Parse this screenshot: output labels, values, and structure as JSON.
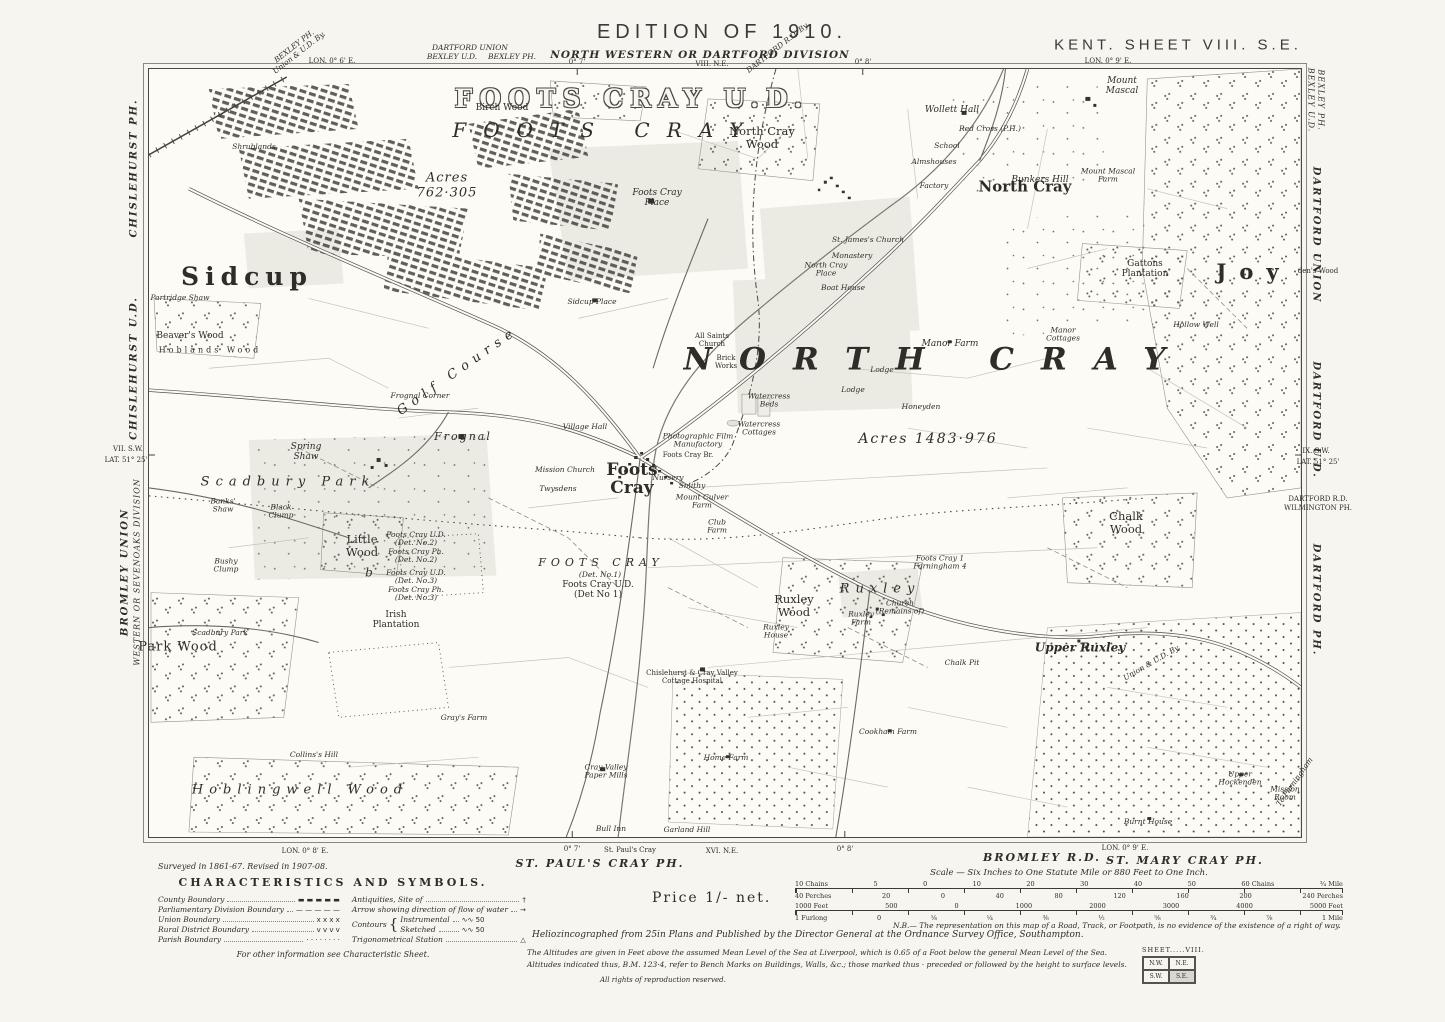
{
  "labels": [
    {
      "t": "EDITION OF 1910.",
      "x": 722,
      "y": 32,
      "c": "hdr",
      "n": "edition-title"
    },
    {
      "t": "KENT. SHEET VIII. S.E.",
      "x": 1178,
      "y": 46,
      "c": "hdr2",
      "n": "sheet-title"
    },
    {
      "t": "NORTH WESTERN OR DARTFORD DIVISION",
      "x": 700,
      "y": 56,
      "c": "div-it",
      "n": "division-title"
    },
    {
      "t": "VIII. N.E.",
      "x": 712,
      "y": 65,
      "c": "tiny",
      "n": "adjoining-sheet-north"
    },
    {
      "t": "DARTFORD UNION",
      "x": 470,
      "y": 48,
      "c": "tiny-it"
    },
    {
      "t": "BEXLEY U.D.",
      "x": 452,
      "y": 57,
      "c": "tiny-it"
    },
    {
      "t": "BEXLEY PH.",
      "x": 512,
      "y": 57,
      "c": "tiny-it"
    },
    {
      "t": "BEXLEY PH.\nUnion & U.D. By.",
      "x": 297,
      "y": 50,
      "c": "tiny-it",
      "r": -38
    },
    {
      "t": "LON. 0° 6' E.",
      "x": 332,
      "y": 62,
      "c": "tiny"
    },
    {
      "t": "0° 7'",
      "x": 577,
      "y": 63,
      "c": "tiny"
    },
    {
      "t": "DARTFORD R.D. By.",
      "x": 778,
      "y": 48,
      "c": "tiny-it",
      "r": -38
    },
    {
      "t": "0° 8'",
      "x": 863,
      "y": 63,
      "c": "tiny"
    },
    {
      "t": "LON. 0° 9' E.",
      "x": 1108,
      "y": 62,
      "c": "tiny"
    },
    {
      "t": "CHISLEHURST PH.",
      "x": 134,
      "y": 168,
      "c": "marg",
      "r": -90
    },
    {
      "t": "CHISLEHURST U.D.",
      "x": 134,
      "y": 368,
      "c": "marg",
      "r": -90
    },
    {
      "t": "VII. S.W.",
      "x": 128,
      "y": 450,
      "c": "tiny"
    },
    {
      "t": "LAT. 51° 25'",
      "x": 126,
      "y": 461,
      "c": "tiny"
    },
    {
      "t": "BROMLEY UNION",
      "x": 125,
      "y": 572,
      "c": "marg",
      "r": -90
    },
    {
      "t": "WESTERN OR SEVENOAKS DIVISION",
      "x": 138,
      "y": 572,
      "c": "marg-sm",
      "r": -90
    },
    {
      "t": "BEXLEY U.D.",
      "x": 1310,
      "y": 100,
      "c": "marg-sm",
      "r": 90
    },
    {
      "t": "BEXLEY PH.",
      "x": 1320,
      "y": 100,
      "c": "marg-sm",
      "r": 90
    },
    {
      "t": "DARTFORD UNION",
      "x": 1316,
      "y": 235,
      "c": "marg",
      "r": 90
    },
    {
      "t": "den's Wood",
      "x": 1318,
      "y": 272,
      "c": "tiny"
    },
    {
      "t": "DARTFORD U.D.",
      "x": 1316,
      "y": 420,
      "c": "marg",
      "r": 90
    },
    {
      "t": "IX. S.W.",
      "x": 1316,
      "y": 452,
      "c": "tiny"
    },
    {
      "t": "LAT. 51° 25'",
      "x": 1318,
      "y": 463,
      "c": "tiny"
    },
    {
      "t": "DARTFORD R.D.",
      "x": 1318,
      "y": 500,
      "c": "tiny"
    },
    {
      "t": "WILMINGTON PH.",
      "x": 1318,
      "y": 509,
      "c": "tiny"
    },
    {
      "t": "DARTFORD PH.",
      "x": 1316,
      "y": 600,
      "c": "marg",
      "r": 90
    },
    {
      "t": "LON. 0° 8' E.",
      "x": 305,
      "y": 852,
      "c": "tiny"
    },
    {
      "t": "0° 7'",
      "x": 572,
      "y": 850,
      "c": "tiny"
    },
    {
      "t": "St. Paul's Cray",
      "x": 630,
      "y": 851,
      "c": "tiny"
    },
    {
      "t": "ST. PAUL'S CRAY PH.",
      "x": 600,
      "y": 864,
      "c": "ph"
    },
    {
      "t": "XVI. N.E.",
      "x": 722,
      "y": 852,
      "c": "tiny",
      "n": "adjoining-sheet-south"
    },
    {
      "t": "0° 8'",
      "x": 845,
      "y": 850,
      "c": "tiny"
    },
    {
      "t": "BROMLEY R.D.",
      "x": 1042,
      "y": 858,
      "c": "ph"
    },
    {
      "t": "LON. 0° 9' E.",
      "x": 1125,
      "y": 849,
      "c": "tiny"
    },
    {
      "t": "ST. MARY CRAY PH.",
      "x": 1185,
      "y": 861,
      "c": "ph"
    },
    {
      "t": "FOOTS CRAY U.D.",
      "x": 632,
      "y": 99,
      "c": "outline",
      "n": "district-title"
    },
    {
      "t": "FOOTS CRAY",
      "x": 606,
      "y": 130,
      "c": "spread-it",
      "n": "parish-title"
    },
    {
      "t": "Acres\n762·305",
      "x": 447,
      "y": 186,
      "c": "acres"
    },
    {
      "t": "Birch Wood",
      "x": 502,
      "y": 108,
      "c": "sm"
    },
    {
      "t": "North Cray\nWood",
      "x": 762,
      "y": 138,
      "c": "wood"
    },
    {
      "t": "Sidcup",
      "x": 247,
      "y": 277,
      "c": "town",
      "n": "town-sidcup"
    },
    {
      "t": "NORTH CRAY",
      "x": 938,
      "y": 360,
      "c": "huge",
      "n": "parish-north-cray"
    },
    {
      "t": "Acres 1483·976",
      "x": 928,
      "y": 440,
      "c": "acres2"
    },
    {
      "t": "North Cray",
      "x": 1025,
      "y": 187,
      "c": "vill",
      "n": "village-north-cray"
    },
    {
      "t": "Mount\nMascal",
      "x": 1122,
      "y": 86,
      "c": "sm-it"
    },
    {
      "t": "Wollett Hall",
      "x": 952,
      "y": 110,
      "c": "sm-it"
    },
    {
      "t": "Red Cross (P.H.)",
      "x": 990,
      "y": 129,
      "c": "tiny-it"
    },
    {
      "t": "School",
      "x": 947,
      "y": 146,
      "c": "tiny-it"
    },
    {
      "t": "Almshouses",
      "x": 934,
      "y": 162,
      "c": "tiny-it"
    },
    {
      "t": "Factory",
      "x": 934,
      "y": 186,
      "c": "tiny-it"
    },
    {
      "t": "Bunkers Hill",
      "x": 1040,
      "y": 180,
      "c": "sm-it"
    },
    {
      "t": "Mount Mascal\nFarm",
      "x": 1108,
      "y": 176,
      "c": "tiny-it"
    },
    {
      "t": "Gattons\nPlantation",
      "x": 1145,
      "y": 269,
      "c": "sm"
    },
    {
      "t": "St. James's Church",
      "x": 868,
      "y": 240,
      "c": "tiny-it"
    },
    {
      "t": "Monastery",
      "x": 852,
      "y": 256,
      "c": "tiny-it"
    },
    {
      "t": "North Cray\nPlace",
      "x": 826,
      "y": 270,
      "c": "tiny-it"
    },
    {
      "t": "Boat House",
      "x": 843,
      "y": 288,
      "c": "tiny-it"
    },
    {
      "t": "Manor Farm",
      "x": 950,
      "y": 344,
      "c": "sm-it"
    },
    {
      "t": "Manor\nCottages",
      "x": 1063,
      "y": 335,
      "c": "tiny-it"
    },
    {
      "t": "Lodge",
      "x": 882,
      "y": 370,
      "c": "tiny-it"
    },
    {
      "t": "Lodge",
      "x": 853,
      "y": 390,
      "c": "tiny-it"
    },
    {
      "t": "Honeyden",
      "x": 921,
      "y": 407,
      "c": "tiny-it"
    },
    {
      "t": "Watercress\nBeds",
      "x": 769,
      "y": 401,
      "c": "tiny-it"
    },
    {
      "t": "Watercress\nCottages",
      "x": 759,
      "y": 429,
      "c": "tiny-it"
    },
    {
      "t": "All Saints\nChurch",
      "x": 712,
      "y": 341,
      "c": "tiny"
    },
    {
      "t": "Brick\nWorks",
      "x": 726,
      "y": 363,
      "c": "tiny"
    },
    {
      "t": "Foots Cray\nPlace",
      "x": 657,
      "y": 198,
      "c": "sm-it"
    },
    {
      "t": "Sidcup Place",
      "x": 592,
      "y": 302,
      "c": "tiny-it"
    },
    {
      "t": "Golf Course",
      "x": 458,
      "y": 372,
      "c": "sp-it",
      "r": -35
    },
    {
      "t": "Frognal",
      "x": 463,
      "y": 437,
      "c": "frognal"
    },
    {
      "t": "Frognal Corner",
      "x": 420,
      "y": 396,
      "c": "tiny-it"
    },
    {
      "t": "Foots\nCray",
      "x": 632,
      "y": 480,
      "c": "vill2",
      "n": "village-foots-cray"
    },
    {
      "t": "Village Hall",
      "x": 585,
      "y": 427,
      "c": "tiny-it"
    },
    {
      "t": "Mission Church",
      "x": 565,
      "y": 470,
      "c": "tiny-it"
    },
    {
      "t": "Twysdens",
      "x": 558,
      "y": 489,
      "c": "tiny-it"
    },
    {
      "t": "Photographic Film\nManufactory",
      "x": 698,
      "y": 441,
      "c": "tiny-it"
    },
    {
      "t": "Foots Cray Br.",
      "x": 688,
      "y": 456,
      "c": "tiny"
    },
    {
      "t": "Nursery",
      "x": 668,
      "y": 478,
      "c": "tiny-it"
    },
    {
      "t": "Smithy",
      "x": 692,
      "y": 486,
      "c": "tiny-it"
    },
    {
      "t": "Mount Culver\nFarm",
      "x": 702,
      "y": 502,
      "c": "tiny-it"
    },
    {
      "t": "Club\nFarm",
      "x": 717,
      "y": 527,
      "c": "tiny-it"
    },
    {
      "t": "Spring\nShaw",
      "x": 306,
      "y": 452,
      "c": "sm-it"
    },
    {
      "t": "Scadbury Park",
      "x": 288,
      "y": 483,
      "c": "sp-it"
    },
    {
      "t": "Banks'\nShaw",
      "x": 223,
      "y": 506,
      "c": "tiny-it"
    },
    {
      "t": "Black\nClump",
      "x": 281,
      "y": 512,
      "c": "tiny-it"
    },
    {
      "t": "Bushy\nClump",
      "x": 226,
      "y": 566,
      "c": "tiny-it"
    },
    {
      "t": "Little\nWood",
      "x": 362,
      "y": 546,
      "c": "wood"
    },
    {
      "t": "b",
      "x": 369,
      "y": 573,
      "c": "bmark"
    },
    {
      "t": "Foots Cray U.D.\n(Det. No.2)\nFoots Cray Ph.\n(Det. No.2)",
      "x": 416,
      "y": 548,
      "c": "tiny-it"
    },
    {
      "t": "Foots Cray U.D.\n(Det. No.3)\nFoots Cray Ph.\n(Det. No.3)",
      "x": 416,
      "y": 586,
      "c": "tiny-it"
    },
    {
      "t": "Irish\nPlantation",
      "x": 396,
      "y": 620,
      "c": "sm"
    },
    {
      "t": "FOOTS CRAY",
      "x": 601,
      "y": 563,
      "c": "det-sp"
    },
    {
      "t": "(Det. No.1)",
      "x": 600,
      "y": 575,
      "c": "tiny-it"
    },
    {
      "t": "Foots Cray U.D.\n(Det No 1)",
      "x": 598,
      "y": 590,
      "c": "sm"
    },
    {
      "t": "Ruxley\nWood",
      "x": 794,
      "y": 606,
      "c": "wood"
    },
    {
      "t": "Ruxley",
      "x": 880,
      "y": 590,
      "c": "sp-it",
      "n": "hamlet-ruxley"
    },
    {
      "t": "Ruxley\nFarm",
      "x": 861,
      "y": 619,
      "c": "tiny-it"
    },
    {
      "t": "Church\n(Remains of)",
      "x": 900,
      "y": 608,
      "c": "tiny-it"
    },
    {
      "t": "Ruxley\nHouse",
      "x": 776,
      "y": 632,
      "c": "tiny-it"
    },
    {
      "t": "Foots Cray 1\nFarningham 4",
      "x": 940,
      "y": 563,
      "c": "tiny-it"
    },
    {
      "t": "Chalk Pit",
      "x": 962,
      "y": 663,
      "c": "tiny-it"
    },
    {
      "t": "Upper Ruxley",
      "x": 1080,
      "y": 648,
      "c": "hamlet",
      "n": "hamlet-upper-ruxley"
    },
    {
      "t": "Chalk\nWood",
      "x": 1126,
      "y": 523,
      "c": "wood"
    },
    {
      "t": "Union & U.D. By.",
      "x": 1152,
      "y": 663,
      "c": "tiny-it",
      "r": -30
    },
    {
      "t": "Park Wood",
      "x": 178,
      "y": 648,
      "c": "wood2"
    },
    {
      "t": "Scadbury Park",
      "x": 220,
      "y": 633,
      "c": "tiny-it"
    },
    {
      "t": "Collins's Hill",
      "x": 314,
      "y": 755,
      "c": "tiny-it"
    },
    {
      "t": "Gray's Farm",
      "x": 464,
      "y": 718,
      "c": "tiny-it"
    },
    {
      "t": "Hoblingwell Wood",
      "x": 300,
      "y": 791,
      "c": "wood-sp"
    },
    {
      "t": "Chislehurst & Cray Valley\nCottage Hospital",
      "x": 692,
      "y": 678,
      "c": "tiny"
    },
    {
      "t": "Cookham Farm",
      "x": 888,
      "y": 732,
      "c": "tiny-it"
    },
    {
      "t": "Home Farm",
      "x": 726,
      "y": 758,
      "c": "tiny-it"
    },
    {
      "t": "Cray Valley\nPaper Mills",
      "x": 606,
      "y": 772,
      "c": "tiny-it"
    },
    {
      "t": "Bull Inn",
      "x": 611,
      "y": 829,
      "c": "tiny-it"
    },
    {
      "t": "Garland Hill",
      "x": 687,
      "y": 830,
      "c": "tiny-it"
    },
    {
      "t": "Upper\nHockenden",
      "x": 1240,
      "y": 779,
      "c": "tiny-it"
    },
    {
      "t": "Mission\nRoom",
      "x": 1285,
      "y": 794,
      "c": "tiny-it"
    },
    {
      "t": "Burnt House",
      "x": 1148,
      "y": 822,
      "c": "tiny-it"
    },
    {
      "t": "To Farningham",
      "x": 1295,
      "y": 782,
      "c": "tiny-it",
      "r": -55
    },
    {
      "t": "Joy",
      "x": 1254,
      "y": 272,
      "c": "joy",
      "n": "wood-joydens"
    },
    {
      "t": "Hollow Well",
      "x": 1196,
      "y": 325,
      "c": "tiny-it"
    },
    {
      "t": "Partridge Shaw",
      "x": 180,
      "y": 298,
      "c": "tiny-it"
    },
    {
      "t": "Beaver's Wood",
      "x": 190,
      "y": 336,
      "c": "sm"
    },
    {
      "t": "Hoblands Wood",
      "x": 210,
      "y": 351,
      "c": "sm-sp"
    },
    {
      "t": "Shrublands",
      "x": 254,
      "y": 147,
      "c": "tiny-it"
    }
  ],
  "legend": {
    "surveyed": "Surveyed in 1861-67.   Revised in 1907-08.",
    "title": "CHARACTERISTICS AND SYMBOLS.",
    "left": [
      {
        "label": "County Boundary",
        "symbol": "▬  ▬  ▬  ▬  ▬"
      },
      {
        "label": "Parliamentary Division Boundary",
        "symbol": "—  —  —  —  —"
      },
      {
        "label": "Union Boundary",
        "symbol": "x    x    x    x"
      },
      {
        "label": "Rural District Boundary",
        "symbol": "v    v    v    v"
      },
      {
        "label": "Parish Boundary",
        "symbol": "·  ·  ·  ·  ·  ·  ·  ·"
      }
    ],
    "right": [
      {
        "label": "Antiquities, Site of",
        "symbol": "†"
      },
      {
        "label": "Arrow showing direction of flow of water",
        "symbol": "→"
      }
    ],
    "contours": {
      "label": "Contours",
      "items": [
        {
          "label": "Instrumental",
          "symbol": "∿∿ 50"
        },
        {
          "label": "Sketched",
          "symbol": "∿∿ 50"
        }
      ]
    },
    "trig": {
      "label": "Trigonometrical Station",
      "symbol": "△"
    },
    "footnote": "For other information see Characteristic Sheet."
  },
  "price": "Price 1/- net.",
  "scale_caption": "Scale — Six Inches to One Statute Mile or 880 Feet to One Inch.",
  "scalebars": {
    "bar1_above": [
      "10 Chains",
      "5",
      "0",
      "10",
      "20",
      "30",
      "40",
      "50",
      "60 Chains",
      "¾ Mile"
    ],
    "bar1_below": [
      "40 Perches",
      "20",
      "0",
      "40",
      "80",
      "120",
      "160",
      "200",
      "240 Perches"
    ],
    "bar2_above": [
      "1000 Feet",
      "500",
      "0",
      "1000",
      "2000",
      "3000",
      "4000",
      "5000 Feet"
    ],
    "bar2_below": [
      "1 Furlong",
      "0",
      "⅛",
      "¼",
      "⅜",
      "½",
      "⅝",
      "¾",
      "⅞",
      "1 Mile"
    ]
  },
  "notes": {
    "nb": "N.B.— The representation on this map of a Road, Track, or Footpath, is no evidence of the existence of a right of way.",
    "helio": "Heliozincographed from 25in Plans and Published by the Director General at the Ordnance Survey Office, Southampton.",
    "alt1": "The Altitudes are given in Feet above the assumed Mean Level of the Sea at Liverpool, which is 0.65 of a Foot below the general Mean Level of the Sea.",
    "alt2": "Altitudes indicated thus, B.M. 123·4, refer to Bench Marks on Buildings, Walls, &c.; those marked thus · preceded or followed by the height to surface levels.",
    "rights": "All rights of reproduction reserved."
  },
  "sheetindex": {
    "title": "SHEET.....VIII.",
    "cells": [
      "N.W.",
      "N.E.",
      "S.W.",
      "S.E."
    ]
  }
}
